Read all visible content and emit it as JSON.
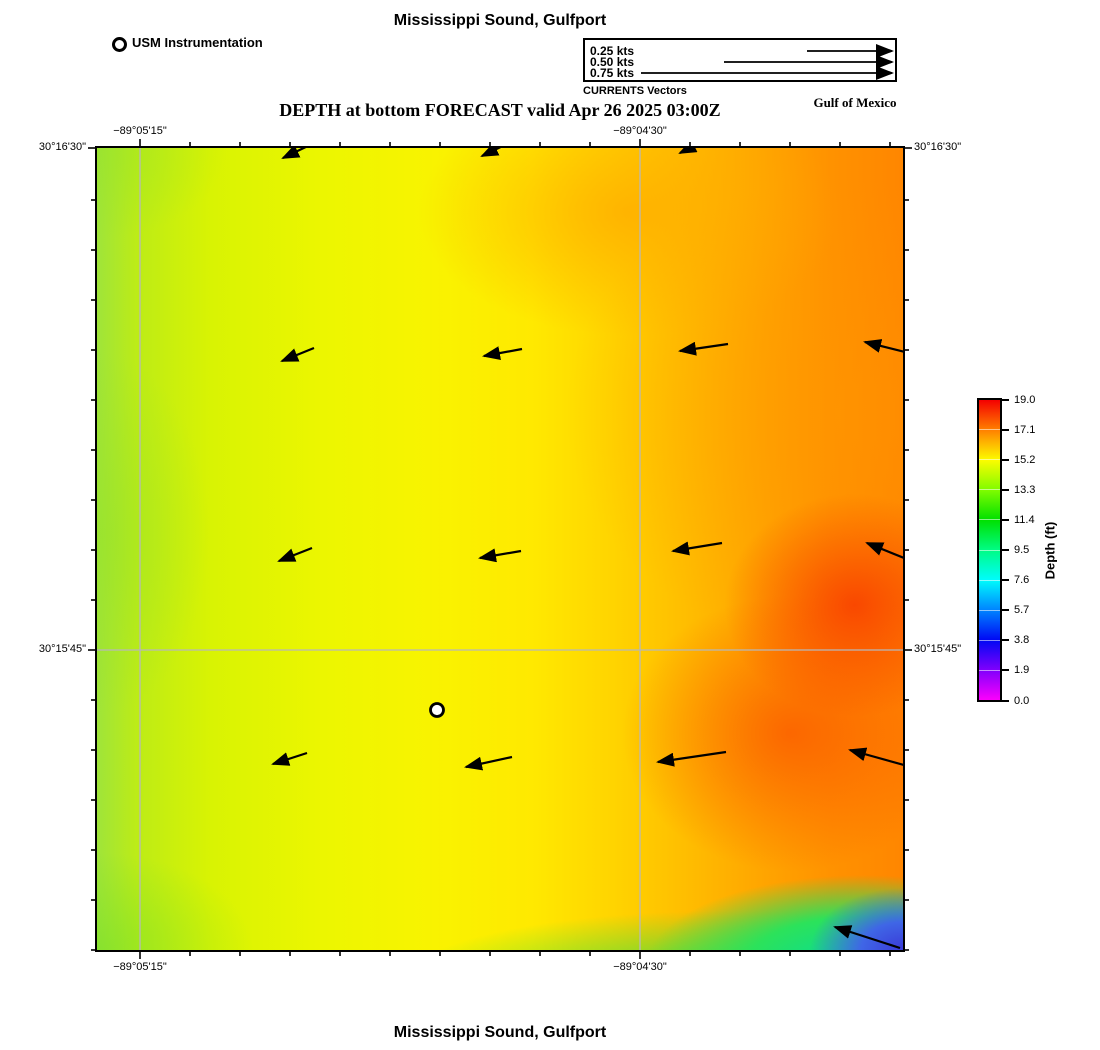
{
  "titles": {
    "top": "Mississippi Sound, Gulfport",
    "subtitle": "DEPTH at bottom FORECAST valid Apr 26 2025 03:00Z",
    "bottom": "Mississippi Sound, Gulfport",
    "region": "Gulf of Mexico"
  },
  "station_legend": {
    "label": "USM Instrumentation"
  },
  "vector_legend": {
    "caption": "CURRENTS Vectors",
    "items": [
      {
        "label": "0.25 kts",
        "length_px": 85
      },
      {
        "label": "0.50 kts",
        "length_px": 168
      },
      {
        "label": "0.75 kts",
        "length_px": 251
      }
    ]
  },
  "axes": {
    "lon_ticks": [
      {
        "label": "−89°05'15\"",
        "x": 43
      },
      {
        "label": "−89°04'30\"",
        "x": 543
      }
    ],
    "lat_ticks": [
      {
        "label": "30°16'30\"",
        "y": 0
      },
      {
        "label": "30°15'45\"",
        "y": 502
      }
    ]
  },
  "colorbar": {
    "title": "Depth (ft)",
    "tick_labels": [
      "19.0",
      "17.1",
      "15.2",
      "13.3",
      "11.4",
      "9.5",
      "7.6",
      "5.7",
      "3.8",
      "1.9",
      "0.0"
    ],
    "gradient_top_to_bottom": [
      "#f40000",
      "#ff8000",
      "#fcfc00",
      "#80fc00",
      "#00e000",
      "#00fc84",
      "#00fcfc",
      "#0084ff",
      "#0008f4",
      "#8000fc",
      "#fc00fc"
    ]
  },
  "chart_data": {
    "type": "heatmap",
    "title": "Mississippi Sound, Gulfport",
    "subtitle": "DEPTH at bottom FORECAST valid Apr 26 2025 03:00Z",
    "variable": "Depth (ft)",
    "colorbar_range": [
      0.0,
      19.0
    ],
    "colorbar_ticks": [
      19.0,
      17.1,
      15.2,
      13.3,
      11.4,
      9.5,
      7.6,
      5.7,
      3.8,
      1.9,
      0.0
    ],
    "x_axis": {
      "tick_labels": [
        "−89°05'15\"",
        "−89°04'30\""
      ]
    },
    "y_axis": {
      "tick_labels": [
        "30°16'30\"",
        "30°15'45\""
      ]
    },
    "depth_grid_ft": {
      "description": "approximate depths read from the color field, 5x5 grid, rows north to south, columns west to east",
      "values": [
        [
          14.6,
          15.3,
          15.9,
          16.8,
          17.3
        ],
        [
          14.4,
          15.2,
          16.1,
          17.1,
          17.8
        ],
        [
          14.2,
          15.1,
          16.3,
          17.5,
          18.4
        ],
        [
          14.0,
          15.0,
          16.6,
          17.9,
          18.2
        ],
        [
          13.8,
          14.7,
          15.3,
          15.8,
          11.5
        ]
      ]
    },
    "station_marker": {
      "label": "USM Instrumentation",
      "x_px": 340,
      "y_px": 562
    },
    "gridlines_px": {
      "x": [
        43,
        543
      ],
      "y": [
        502
      ]
    },
    "current_vectors_px": [
      {
        "x1": 186,
        "y1": 10,
        "x2": 215,
        "y2": -4
      },
      {
        "x1": 385,
        "y1": 8,
        "x2": 414,
        "y2": -6
      },
      {
        "x1": 583,
        "y1": 5,
        "x2": 611,
        "y2": -9
      },
      {
        "x1": 185,
        "y1": 213,
        "x2": 217,
        "y2": 200
      },
      {
        "x1": 387,
        "y1": 208,
        "x2": 425,
        "y2": 201
      },
      {
        "x1": 583,
        "y1": 203,
        "x2": 631,
        "y2": 196
      },
      {
        "x1": 768,
        "y1": 194,
        "x2": 812,
        "y2": 205
      },
      {
        "x1": 182,
        "y1": 413,
        "x2": 215,
        "y2": 400
      },
      {
        "x1": 383,
        "y1": 410,
        "x2": 424,
        "y2": 403
      },
      {
        "x1": 576,
        "y1": 403,
        "x2": 625,
        "y2": 395
      },
      {
        "x1": 770,
        "y1": 395,
        "x2": 812,
        "y2": 412
      },
      {
        "x1": 176,
        "y1": 616,
        "x2": 210,
        "y2": 605
      },
      {
        "x1": 369,
        "y1": 619,
        "x2": 415,
        "y2": 609
      },
      {
        "x1": 561,
        "y1": 614,
        "x2": 629,
        "y2": 604
      },
      {
        "x1": 753,
        "y1": 602,
        "x2": 814,
        "y2": 619
      },
      {
        "x1": 738,
        "y1": 779,
        "x2": 803,
        "y2": 800
      }
    ]
  }
}
